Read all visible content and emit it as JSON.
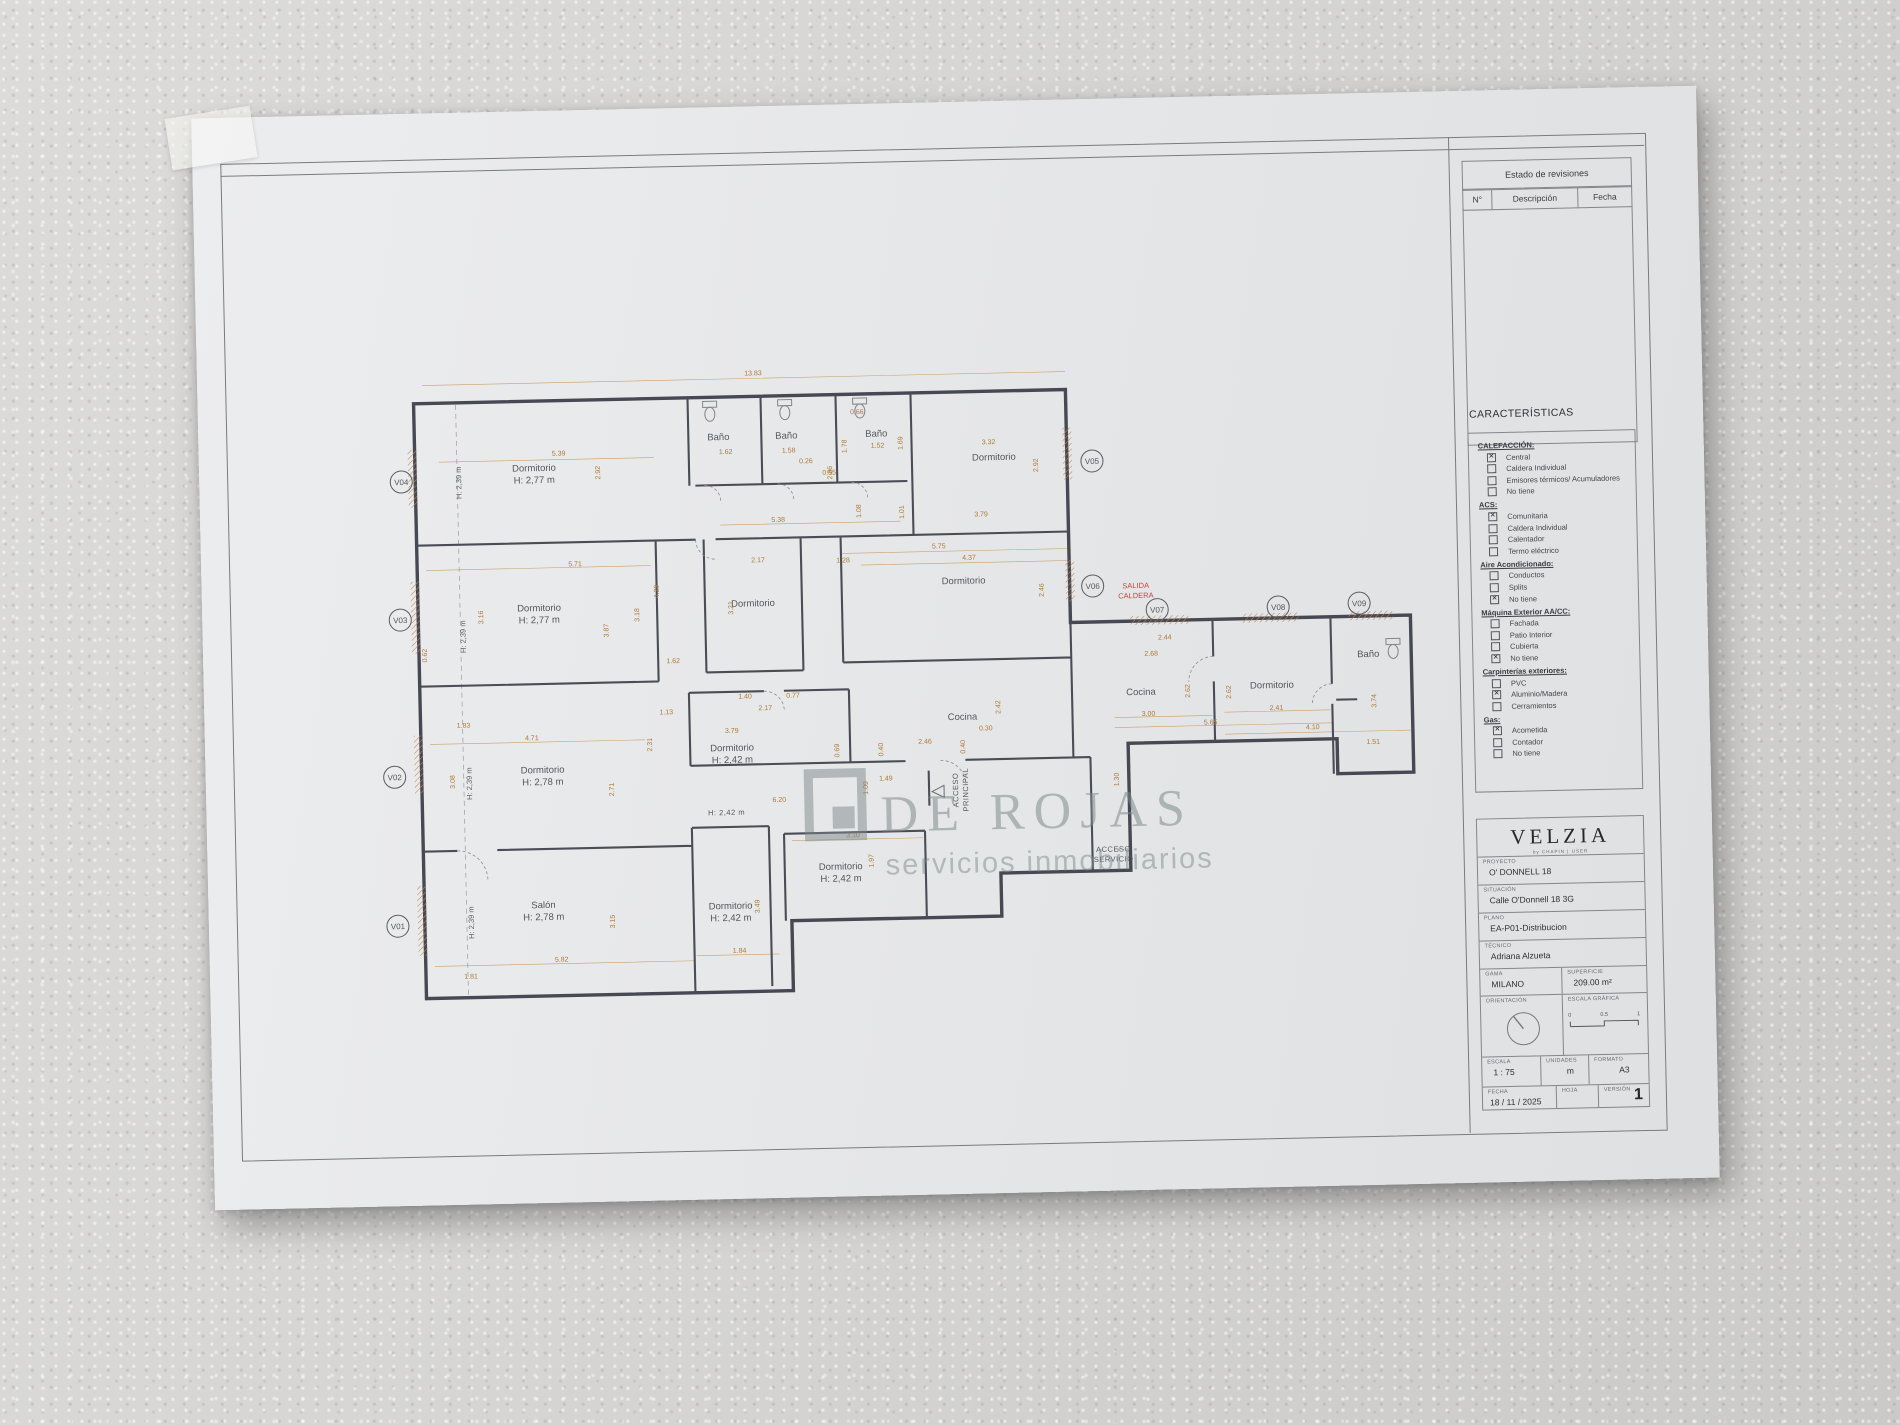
{
  "revision_table": {
    "title": "Estado de revisiones",
    "columns": [
      "N°",
      "Descripción",
      "Fecha"
    ]
  },
  "caracteristicas": {
    "title": "CARACTERÍSTICAS",
    "groups": [
      {
        "label": "CALEFACCIÓN:",
        "items": [
          {
            "label": "Central",
            "checked": true
          },
          {
            "label": "Caldera Individual",
            "checked": false
          },
          {
            "label": "Emisores térmicos/ Acumuladores",
            "checked": false
          },
          {
            "label": "No tiene",
            "checked": false
          }
        ]
      },
      {
        "label": "ACS:",
        "items": [
          {
            "label": "Comunitaria",
            "checked": true
          },
          {
            "label": "Caldera Individual",
            "checked": false
          },
          {
            "label": "Calentador",
            "checked": false
          },
          {
            "label": "Termo eléctrico",
            "checked": false
          }
        ]
      },
      {
        "label": "Aire Acondicionado:",
        "items": [
          {
            "label": "Conductos",
            "checked": false
          },
          {
            "label": "Splits",
            "checked": false
          },
          {
            "label": "No tiene",
            "checked": true
          }
        ]
      },
      {
        "label": "Máquina Exterior AA/CC:",
        "items": [
          {
            "label": "Fachada",
            "checked": false
          },
          {
            "label": "Patio Interior",
            "checked": false
          },
          {
            "label": "Cubierta",
            "checked": false
          },
          {
            "label": "No tiene",
            "checked": true
          }
        ]
      },
      {
        "label": "Carpinterías exteriores:",
        "items": [
          {
            "label": "PVC",
            "checked": false
          },
          {
            "label": "Aluminio/Madera",
            "checked": true
          },
          {
            "label": "Cerramientos",
            "checked": false
          }
        ]
      },
      {
        "label": "Gas:",
        "items": [
          {
            "label": "Acometida",
            "checked": true
          },
          {
            "label": "Contador",
            "checked": false
          },
          {
            "label": "No tiene",
            "checked": false
          }
        ]
      }
    ]
  },
  "title_block": {
    "brand": "VELZIA",
    "brand_tagline": "by CHAPIN | USER",
    "fields": [
      {
        "label": "PROYECTO",
        "value": "O' DONNELL 18"
      },
      {
        "label": "SITUACIÓN",
        "value": "Calle O'Donnell 18 3G"
      },
      {
        "label": "PLANO",
        "value": "EA-P01-Distribucion"
      },
      {
        "label": "TÉCNICO",
        "value": "Adriana Alzueta"
      }
    ],
    "gama_label": "GAMA",
    "gama_value": "MILANO",
    "superficie_label": "SUPERFICIE",
    "superficie_value": "209.00 m²",
    "orientacion_label": "ORIENTACIÓN",
    "escala_grafica_label": "ESCALA GRÁFICA",
    "scale_ticks": [
      "0",
      "0.5",
      "1"
    ],
    "escala_label": "ESCALA",
    "escala_value": "1 : 75",
    "unidades_label": "UNIDADES",
    "unidades_value": "m",
    "formato_label": "FORMATO",
    "formato_value": "A3",
    "fecha_label": "FECHA",
    "fecha_value": "18 / 11 / 2025",
    "hoja_label": "HOJA",
    "version_label": "VERSIÓN",
    "version_value": "1"
  },
  "watermark": {
    "line1": "DE ROJAS",
    "line2": "servicios inmobiliarios"
  },
  "plan": {
    "rooms": [
      {
        "name": "Dormitorio",
        "h": "H: 2,77 m",
        "x": 335,
        "y": 360
      },
      {
        "name": "Baño",
        "x": 520,
        "y": 333
      },
      {
        "name": "Baño",
        "x": 588,
        "y": 333
      },
      {
        "name": "Baño",
        "x": 678,
        "y": 333
      },
      {
        "name": "Dormitorio",
        "x": 795,
        "y": 359
      },
      {
        "name": "Dormitorio",
        "h": "H: 2,77 m",
        "x": 337,
        "y": 500
      },
      {
        "name": "Dormitorio",
        "x": 551,
        "y": 500
      },
      {
        "name": "Dormitorio",
        "x": 762,
        "y": 482
      },
      {
        "name": "Dormitorio",
        "h": "H: 2,42 m",
        "x": 527,
        "y": 644
      },
      {
        "name": "Cocina",
        "x": 758,
        "y": 618
      },
      {
        "name": "Dormitorio",
        "h": "H: 2,78 m",
        "x": 337,
        "y": 662
      },
      {
        "name": "Salón",
        "h": "H: 2,78 m",
        "x": 335,
        "y": 797
      },
      {
        "name": "Dormitorio",
        "h": "H: 2,42 m",
        "x": 522,
        "y": 802
      },
      {
        "name": "Dormitorio",
        "h": "H: 2,42 m",
        "x": 633,
        "y": 765
      },
      {
        "name": "Cocina",
        "x": 937,
        "y": 597
      },
      {
        "name": "Dormitorio",
        "x": 1068,
        "y": 593
      },
      {
        "name": "Baño",
        "x": 1165,
        "y": 564
      }
    ],
    "dims": [
      {
        "t": "13.83",
        "x": 556,
        "y": 269
      },
      {
        "t": "5.39",
        "x": 360,
        "y": 345
      },
      {
        "t": "2.92",
        "x": 401,
        "y": 363,
        "r": 1
      },
      {
        "t": "1.62",
        "x": 527,
        "y": 347
      },
      {
        "t": "1.58",
        "x": 590,
        "y": 347
      },
      {
        "t": "0.26",
        "x": 607,
        "y": 358
      },
      {
        "t": "0.55",
        "x": 630,
        "y": 370
      },
      {
        "t": "0.66",
        "x": 659,
        "y": 310
      },
      {
        "t": "1.78",
        "x": 648,
        "y": 342,
        "r": 1
      },
      {
        "t": "1.52",
        "x": 679,
        "y": 344
      },
      {
        "t": "1.69",
        "x": 704,
        "y": 340,
        "r": 1
      },
      {
        "t": "2.86",
        "x": 633,
        "y": 368,
        "r": 1
      },
      {
        "t": "1.08",
        "x": 661,
        "y": 407,
        "r": 1
      },
      {
        "t": "1.01",
        "x": 704,
        "y": 409,
        "r": 1
      },
      {
        "t": "5.38",
        "x": 578,
        "y": 416
      },
      {
        "t": "3.32",
        "x": 790,
        "y": 343
      },
      {
        "t": "2.92",
        "x": 839,
        "y": 365,
        "r": 1
      },
      {
        "t": "3.79",
        "x": 781,
        "y": 415
      },
      {
        "t": "5.71",
        "x": 374,
        "y": 456
      },
      {
        "t": "3.16",
        "x": 281,
        "y": 505,
        "r": 1
      },
      {
        "t": "3.87",
        "x": 406,
        "y": 521,
        "r": 1
      },
      {
        "t": "0.62",
        "x": 224,
        "y": 542,
        "r": 1
      },
      {
        "t": "4.29",
        "x": 457,
        "y": 483,
        "r": 1
      },
      {
        "t": "3.18",
        "x": 437,
        "y": 506,
        "r": 1
      },
      {
        "t": "2.17",
        "x": 557,
        "y": 456
      },
      {
        "t": "3.21",
        "x": 531,
        "y": 501,
        "r": 1
      },
      {
        "t": "1.62",
        "x": 470,
        "y": 555
      },
      {
        "t": "1.28",
        "x": 642,
        "y": 458
      },
      {
        "t": "5.75",
        "x": 738,
        "y": 446
      },
      {
        "t": "4.37",
        "x": 768,
        "y": 458
      },
      {
        "t": "2.46",
        "x": 842,
        "y": 490,
        "r": 1
      },
      {
        "t": "2.44",
        "x": 962,
        "y": 542
      },
      {
        "t": "1.13",
        "x": 462,
        "y": 606
      },
      {
        "t": "1.40",
        "x": 541,
        "y": 592
      },
      {
        "t": "0.77",
        "x": 589,
        "y": 592
      },
      {
        "t": "2.17",
        "x": 561,
        "y": 604
      },
      {
        "t": "3.79",
        "x": 527,
        "y": 626
      },
      {
        "t": "2.31",
        "x": 447,
        "y": 636,
        "r": 1
      },
      {
        "t": "2.42",
        "x": 796,
        "y": 606,
        "r": 1
      },
      {
        "t": "0.30",
        "x": 781,
        "y": 629
      },
      {
        "t": "2.46",
        "x": 720,
        "y": 641
      },
      {
        "t": "0.40",
        "x": 678,
        "y": 646,
        "r": 1
      },
      {
        "t": "0.40",
        "x": 760,
        "y": 645,
        "r": 1
      },
      {
        "t": "0.69",
        "x": 634,
        "y": 646,
        "r": 1
      },
      {
        "t": "1.49",
        "x": 680,
        "y": 677
      },
      {
        "t": "1.09",
        "x": 662,
        "y": 684,
        "r": 1
      },
      {
        "t": "6.20",
        "x": 573,
        "y": 696
      },
      {
        "t": "1.83",
        "x": 259,
        "y": 615
      },
      {
        "t": "4.71",
        "x": 327,
        "y": 629
      },
      {
        "t": "3.08",
        "x": 249,
        "y": 669,
        "r": 1
      },
      {
        "t": "2.71",
        "x": 408,
        "y": 680,
        "r": 1
      },
      {
        "t": "3.15",
        "x": 406,
        "y": 812,
        "r": 1
      },
      {
        "t": "5.82",
        "x": 352,
        "y": 851
      },
      {
        "t": "1.81",
        "x": 261,
        "y": 866
      },
      {
        "t": "3.49",
        "x": 551,
        "y": 800,
        "r": 1
      },
      {
        "t": "1.84",
        "x": 530,
        "y": 846
      },
      {
        "t": "3.10",
        "x": 646,
        "y": 733
      },
      {
        "t": "1.97",
        "x": 666,
        "y": 757,
        "r": 1
      },
      {
        "t": "2.68",
        "x": 948,
        "y": 558
      },
      {
        "t": "2.62",
        "x": 986,
        "y": 594,
        "r": 1
      },
      {
        "t": "3.00",
        "x": 944,
        "y": 618
      },
      {
        "t": "5.65",
        "x": 1006,
        "y": 628
      },
      {
        "t": "2.41",
        "x": 1072,
        "y": 615
      },
      {
        "t": "2.62",
        "x": 1027,
        "y": 596,
        "r": 1
      },
      {
        "t": "4.10",
        "x": 1108,
        "y": 635
      },
      {
        "t": "3.74",
        "x": 1172,
        "y": 608,
        "r": 1
      },
      {
        "t": "1.51",
        "x": 1168,
        "y": 651
      },
      {
        "t": "1.30",
        "x": 913,
        "y": 681,
        "r": 1
      }
    ],
    "height_labels": {
      "text": "H: 2,39 m",
      "positions": [
        {
          "x": 262,
          "y": 370
        },
        {
          "x": 263,
          "y": 524
        },
        {
          "x": 266,
          "y": 671
        },
        {
          "x": 265,
          "y": 810
        }
      ]
    },
    "annotations": [
      {
        "lines": [
          "ACCESO",
          "PRINCIPAL"
        ],
        "x": 752,
        "y": 688,
        "r": 1
      },
      {
        "lines": [
          "ACCESO",
          "SERVICIO"
        ],
        "x": 906,
        "y": 753
      },
      {
        "lines": [
          "H: 2,42 m"
        ],
        "x": 520,
        "y": 708
      }
    ],
    "red_labels": [
      {
        "lines": [
          "SALIDA",
          "CALDERA"
        ],
        "x": 934,
        "y": 490
      }
    ],
    "windows": [
      {
        "id": "V01",
        "x": 189,
        "y": 812
      },
      {
        "id": "V02",
        "x": 189,
        "y": 663
      },
      {
        "id": "V03",
        "x": 198,
        "y": 506
      },
      {
        "id": "V04",
        "x": 202,
        "y": 368
      },
      {
        "id": "V05",
        "x": 893,
        "y": 362
      },
      {
        "id": "V06",
        "x": 891,
        "y": 487
      },
      {
        "id": "V07",
        "x": 955,
        "y": 512
      },
      {
        "id": "V08",
        "x": 1076,
        "y": 512
      },
      {
        "id": "V09",
        "x": 1157,
        "y": 510
      }
    ]
  }
}
